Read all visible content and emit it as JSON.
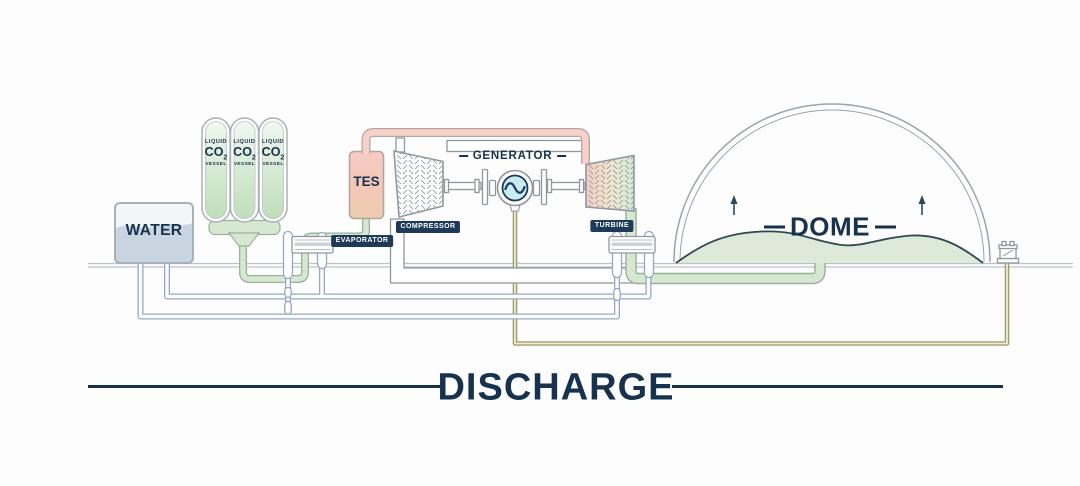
{
  "title": {
    "text": "DISCHARGE"
  },
  "colors": {
    "navy": "#1d3a59",
    "text_navy": "#16324e",
    "outline_gray": "#8f979f",
    "green": "#d6e8d1",
    "green_outline": "#9cb199",
    "blue_outline": "#93a8c4",
    "pink": "#f7d0c8",
    "pink_outline": "#b5a8a2",
    "olive": "#a59e66",
    "teal": "#c9ecf1",
    "mound": "#dde9d9",
    "mound_outline": "#2e4a52",
    "ground": "#bcc2c8"
  },
  "components": {
    "water_tank": {
      "label": "WATER"
    },
    "vessels": [
      {
        "line1": "LIQUID",
        "formula": "CO",
        "subscript": "2",
        "line3": "VESSEL"
      },
      {
        "line1": "LIQUID",
        "formula": "CO",
        "subscript": "2",
        "line3": "VESSEL"
      },
      {
        "line1": "LIQUID",
        "formula": "CO",
        "subscript": "2",
        "line3": "VESSEL"
      }
    ],
    "tes": {
      "label": "TES"
    },
    "evaporator": {
      "label": "EVAPORATOR"
    },
    "compressor": {
      "label": "COMPRESSOR"
    },
    "generator": {
      "label": "GENERATOR"
    },
    "turbine": {
      "label": "TURBINE"
    },
    "dome": {
      "label": "DOME"
    }
  }
}
